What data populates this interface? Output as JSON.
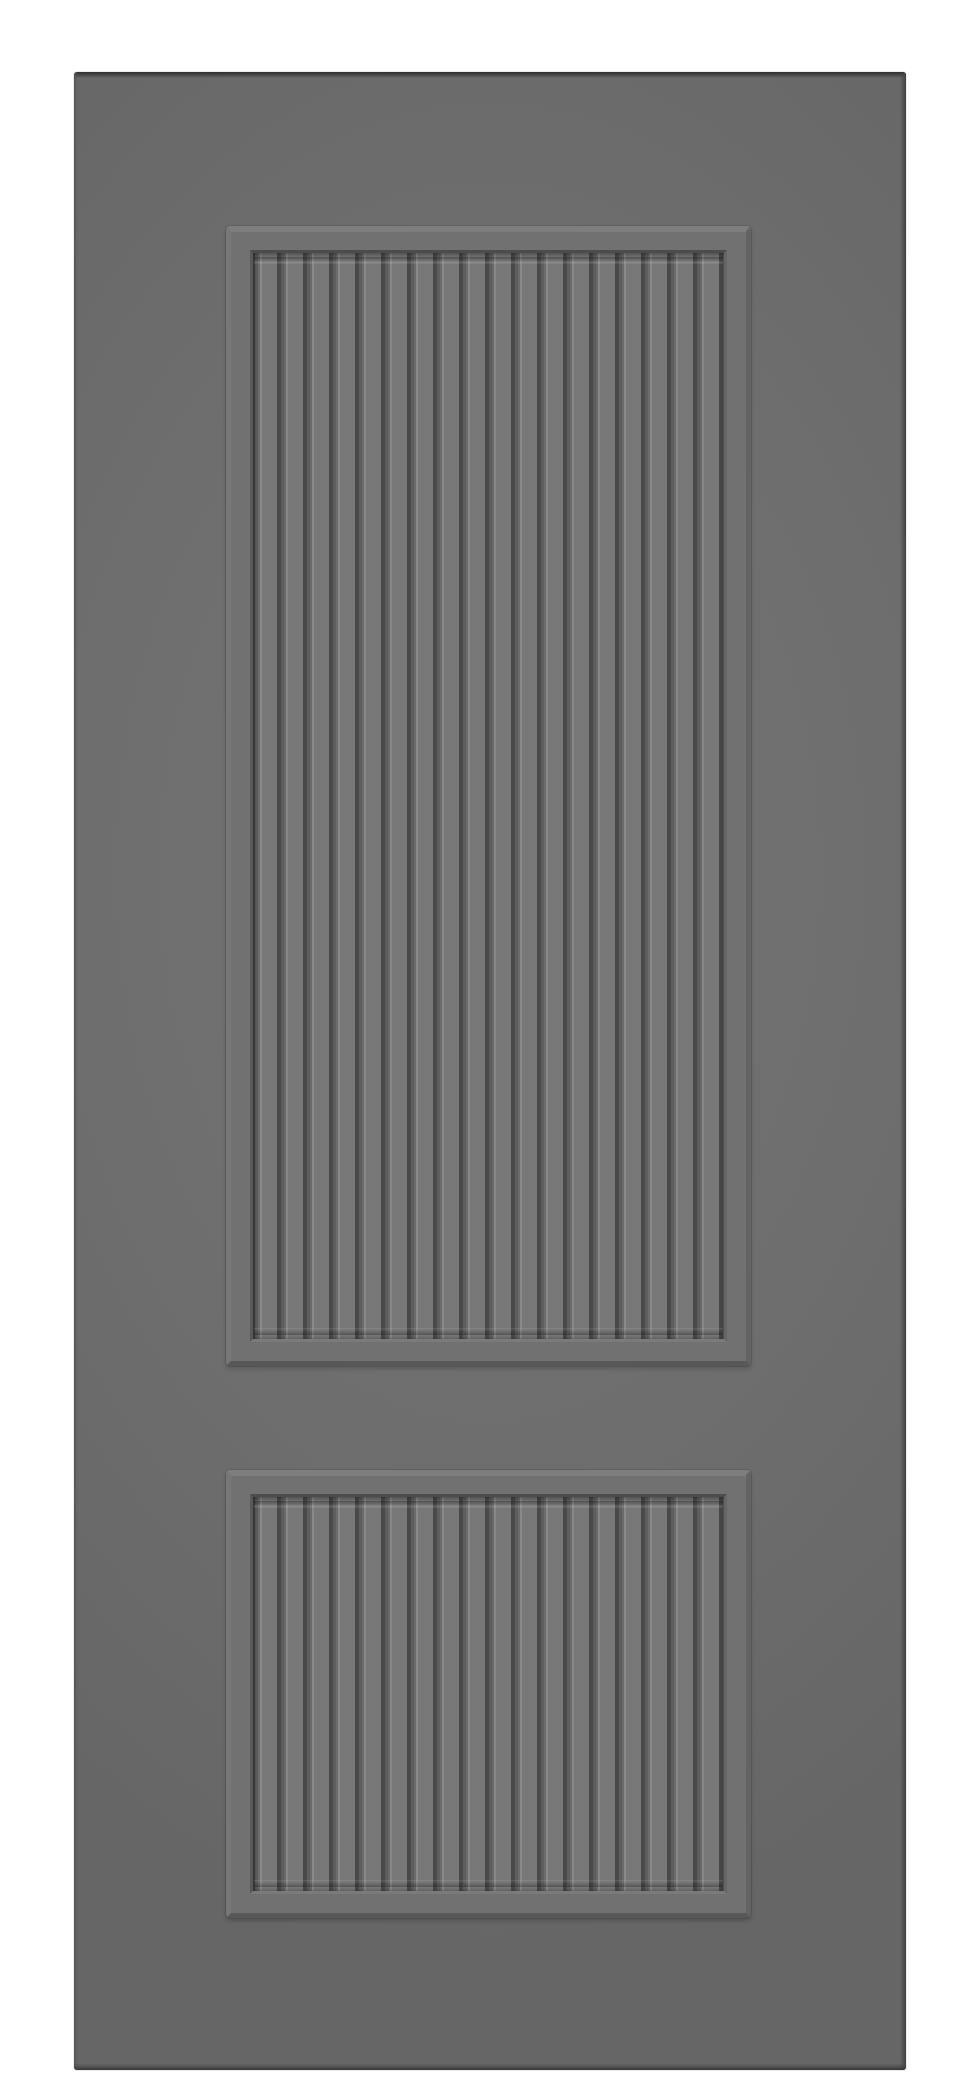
{
  "scene": {
    "description": "Product render of a grey two-panel interior door slab, front view, on a white background",
    "object": "Grey door slab with two recessed vertical-fluted panels",
    "background_color": "#ffffff"
  },
  "door": {
    "panel_count": 2,
    "flutes_per_panel": 18,
    "upper_panel": "tall fluted recessed panel",
    "lower_panel": "short fluted recessed panel",
    "hardware": "none visible",
    "text": "none visible"
  },
  "colors": {
    "bg": "#ffffff",
    "face": "#6e6e6e",
    "face_light": "#757575",
    "face_dark": "#666666",
    "band": "#717171",
    "bevel_light": "#7e7e7e",
    "bevel_side_left": "#777777",
    "bevel_side_right": "#636363",
    "bevel_dark": "#585858",
    "frame_top": "#4c4c4c",
    "frame_left": "#595959",
    "frame_right": "#666666",
    "frame_bottom": "#7a7a7a",
    "groove_dark": "#4a4a4a",
    "groove_mid": "#5e5e5e",
    "groove_light": "#6b6b6b",
    "rib_highlight": "#898989",
    "rib_face": "#787878",
    "rib_shadow": "#484848",
    "edge_top": "#2e2e2e",
    "edge_bottom": "#353535",
    "edge_left": "#565656",
    "edge_right": "#414141"
  }
}
